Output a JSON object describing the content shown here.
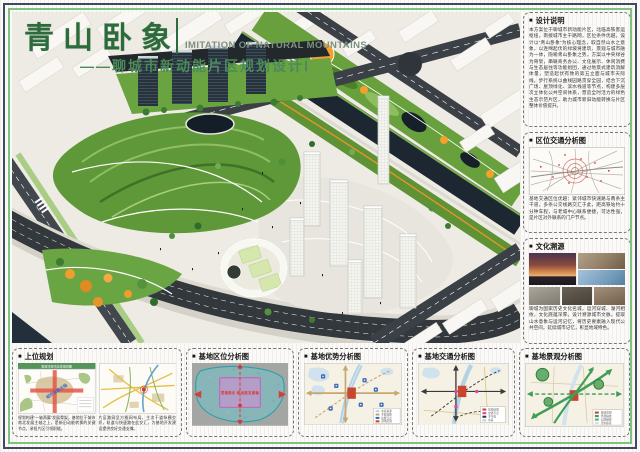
{
  "ui": {
    "bullet": "■"
  },
  "header": {
    "title": "青山卧象",
    "subtitle_en": "IMITATION OF NATURAL MOUNTAINS",
    "subtitle_zh": "——聊城市新动能片区规划设计Ⅰ"
  },
  "colors": {
    "frame_navy": "#3e4a5e",
    "frame_green": "#7cc47c",
    "title_green": "#2e6b3c",
    "site_red": "#c8452f"
  },
  "sidebar": {
    "design_notes": {
      "label": "设计说明",
      "body": "本方案位于聊城市新动能片区，北临高铁客运枢纽，南接城市主干路网，区位条件优越。设计以“青山卧象”为核心理念，取自然山水之意象，以连绵起伏的绿坡将建筑、景观与城市融为一体，隐喻青山卧象之势。方案以中央绿谷为骨架，串联商务办公、文化展示、休闲消费与生态居住等功能组团，通过地景式建筑消解体量，塑造起伏有致的第五立面与城市天际线。步行系统以曲线园路贯穿全园，结合下沉广场、屋顶绿化、滨水栈道等节点，构建多层次立体化公共空间体系，营造全时活力的绿色生态示范片区，助力城市新旧动能转换与片区整体价值提升。"
    },
    "traffic_analysis": {
      "label": "区位交通分析图",
      "caption": "基地交通区位优越：紧邻城市快速路与两条主干道，多条公交线路交汇于此，距高铁站约十分钟车程，与老城中心联系便捷，可达性强，是片区对外联系的门户节点。"
    },
    "culture": {
      "label": "文化溯源",
      "caption": "聊城为国家历史文化名城，运河穿城、湖河相依，文化底蕴深厚。设计溯源城市文脉，提取山水意象与运河记忆，将历史要素融入现代公共空间，延续城市记忆，彰显地域特色。"
    }
  },
  "bottom_panels": {
    "upper_plan": {
      "label": "上位规划",
      "map1_banner": "聊城市城市总体规划图",
      "axis_label": "城市发展主轴",
      "caption1": "规划构建“一轴两翼”发展骨架，基地位于城市南北发展主轴之上，是新旧动能转换的关键节点，承担片区引领职能。",
      "caption2": "片区路网呈方格网布局，主次干道纵横交织，轨道与快速路在此交汇，为基地开发建设提供良好交通支撑。"
    },
    "site_location": {
      "label": "基地区位分析图",
      "axis_label": "贯通南北·新动能发展轴"
    },
    "site_advantage": {
      "label": "基地优势分析图",
      "legend": [
        "水系资源",
        "主要道路",
        "功能节点",
        "基地范围"
      ]
    },
    "site_traffic": {
      "label": "基地交通分析图",
      "legend": [
        "基地范围",
        "交通节点",
        "主干道",
        "水系"
      ]
    },
    "site_landscape": {
      "label": "基地景观分析图",
      "legend": [
        "基地范围",
        "景观轴线",
        "公园绿地",
        "滨水廊道"
      ]
    }
  }
}
